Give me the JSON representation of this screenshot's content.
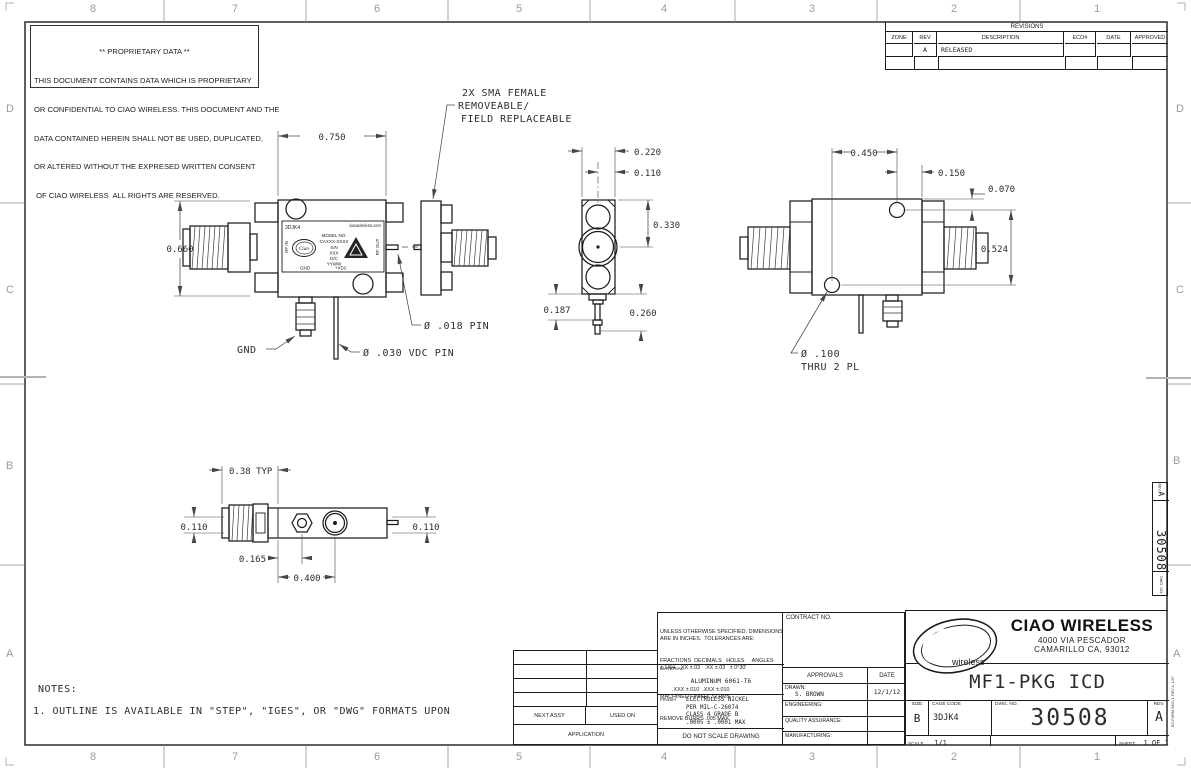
{
  "sheet": {
    "zone_cols": [
      "8",
      "7",
      "6",
      "5",
      "4",
      "3",
      "2",
      "1"
    ],
    "zone_rows": [
      "D",
      "C",
      "B",
      "A"
    ],
    "form_note": "BG-FORM 0001-1, REV A, 1/97"
  },
  "proprietary": {
    "lines": [
      "** PROPRIETARY DATA **",
      "THIS DOCUMENT CONTAINS DATA WHICH IS PROPRIETARY",
      "OR CONFIDENTIAL TO CIAO WIRELESS. THIS DOCUMENT AND THE",
      "DATA CONTAINED HEREIN SHALL NOT BE USED, DUPLICATED,",
      "OR ALTERED WITHOUT THE EXPRESED WRITTEN CONSENT",
      " OF CIAO WIRELESS  ALL RIGHTS ARE RESERVED."
    ]
  },
  "revisions": {
    "title": "REVISIONS",
    "headers": {
      "zone": "ZONE",
      "rev": "REV",
      "description": "DESCRIPTION",
      "eco": "ECO#",
      "date": "DATE",
      "approved": "APPROVED"
    },
    "rows": [
      {
        "zone": "",
        "rev": "A",
        "description": "RELEASED",
        "eco": "",
        "date": "",
        "approved": ""
      }
    ]
  },
  "callouts": {
    "sma_line1": "2X SMA FEMALE",
    "sma_line2": "REMOVEABLE/",
    "sma_line3": "FIELD REPLACEABLE",
    "gnd": "GND",
    "vdc_pin": "Ø .030 VDC PIN",
    "rf_pin": "Ø .018 PIN",
    "hole_line1": "Ø .100",
    "hole_line2": "THRU 2 PL"
  },
  "dims": {
    "front_width": "0.750",
    "front_height": "0.660",
    "end_width": "0.220",
    "end_pin_offset": "0.110",
    "end_height": "0.330",
    "end_stub": "0.187",
    "end_pin_len": "0.260",
    "back_hole_span": "0.450",
    "back_hole_edge": "0.150",
    "back_hole_top": "0.070",
    "back_hole_vspan": "0.524",
    "bot_conn": "0.38 TYP",
    "bot_left": "0.110",
    "bot_right": "0.110",
    "bot_hex": "0.165",
    "bot_circle": "0.400"
  },
  "label": {
    "part": "3DJK4",
    "site": "ciaowireless.com",
    "model_label": "MODEL NO.",
    "model": "CAXXX-XXXX",
    "sn_label": "S/N",
    "sn": "XXX",
    "dc_label": "D/C",
    "dc": "YYWW",
    "rf_in": "RF IN",
    "rf_out": "RF OUT",
    "gnd": "GND",
    "vdc": "+VDC",
    "logo": "Ciao"
  },
  "notes": {
    "title": "NOTES:",
    "items": [
      "1. OUTLINE IS AVAILABLE IN \"STEP\", \"IGES\", OR \"DWG\" FORMATS UPON"
    ]
  },
  "application": {
    "next_assy": "NEXT ASSY",
    "used_on": "USED ON",
    "label": "APPLICATION"
  },
  "tolerances": {
    "lines": [
      "UNLESS OTHERWISE SPECIFIED: DIMENSIONS",
      "ARE IN INCHES.  TOLERANCES ARE:",
      "FRACTIONS  DECIMALS   HOLES     ANGLES",
      "± 1/64   .XX ±.03   .XX ±.03   ± 0°30'",
      "        .XXX ±.010  .XXX ±.010",
      "MACHINED FINISH: 32 RMS",
      "REMOVE BURRS .005 MAX"
    ]
  },
  "material": {
    "label": "MATERIAL",
    "value": "ALUMINUM 6061-T6"
  },
  "finish": {
    "label": "FINISH",
    "lines": [
      "ELECTROLESS NICKEL",
      "PER MIL-C-26074",
      "CLASS 4 GRADE B",
      ".0005 ± .0001 MAX"
    ]
  },
  "do_not_scale": "DO NOT SCALE DRAWING",
  "contract": {
    "label": "CONTRACT NO."
  },
  "approvals": {
    "header": "APPROVALS",
    "date_header": "DATE",
    "rows": [
      {
        "label": "DRAWN:",
        "name": "S. BROWN",
        "date": "12/1/12"
      },
      {
        "label": "ENGINEERING:",
        "name": "",
        "date": ""
      },
      {
        "label": "QUALITY ASSURANCE:",
        "name": "",
        "date": ""
      },
      {
        "label": "MANUFACTURING:",
        "name": "",
        "date": ""
      }
    ]
  },
  "title_block": {
    "company": "CIAO WIRELESS",
    "address1": "4000 VIA PESCADOR",
    "address2": "CAMARILLO CA, 93012",
    "logo_c": "C",
    "logo_iao": "iao",
    "logo_sub": "wireless",
    "title": "MF1-PKG ICD",
    "size_label": "SIZE",
    "size": "B",
    "cage_label": "CAGE CODE",
    "cage": "3DJK4",
    "dwg_label": "DWG. NO.",
    "dwg_no": "30508",
    "rev_label": "REV.",
    "rev": "A",
    "scale_label": "SCALE",
    "scale": "1/1",
    "sheet_label": "SHEET",
    "sheet": "1 OF 1"
  },
  "edge_strip": {
    "rev_label": "REV.",
    "rev": "A",
    "dwg_no": "30508",
    "dwg_label": "DWG. NO."
  }
}
